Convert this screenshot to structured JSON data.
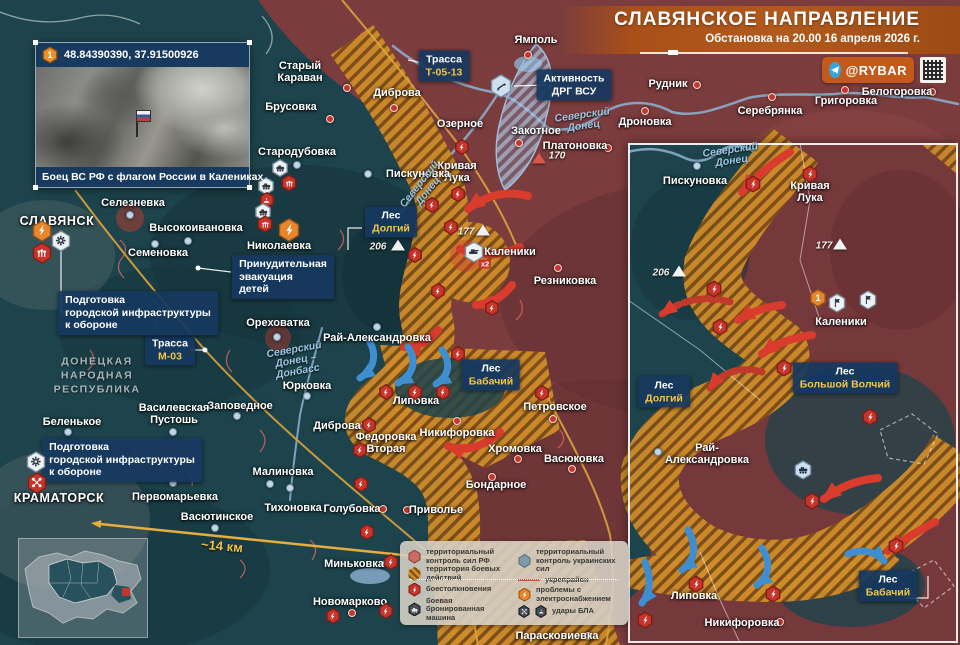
{
  "header": {
    "title": "СЛАВЯНСКОЕ НАПРАВЛЕНИЕ",
    "subtitle": "Обстановка на 20.00 16 апреля 2026 г.",
    "channel": "@RYBAR"
  },
  "photo_inset": {
    "marker": "1",
    "coordinates": "48.84390390, 37.91500926",
    "caption": "Боец ВС РФ с флагом России в Калениках"
  },
  "region_label": "ДОНЕЦКАЯ\nНАРОДНАЯ\nРЕСПУБЛИКА",
  "scale_label": "~14 км",
  "colors": {
    "rf_zone": "#7b3c3e",
    "ua_zone": "#1d444c",
    "combat_hatch": "#cf8c2a",
    "label_box": "#16385F",
    "accent_yellow": "#f2c545",
    "red_icon": "#c7342a",
    "orange_icon": "#e8862b",
    "red_arrow": "#d93b2c",
    "blue_arrow": "#3f8ed0"
  },
  "main_map": {
    "towns": [
      {
        "name": "Ямполь",
        "x": 536,
        "y": 40,
        "dot": [
          528,
          55
        ],
        "dc": "red"
      },
      {
        "name": "Старый\nКараван",
        "x": 300,
        "y": 72,
        "dot": [
          347,
          88
        ],
        "dc": "red"
      },
      {
        "name": "Диброва",
        "x": 397,
        "y": 93,
        "dot": [
          394,
          108
        ],
        "dc": "red"
      },
      {
        "name": "Брусовка",
        "x": 291,
        "y": 107,
        "dot": [
          330,
          119
        ],
        "dc": "red"
      },
      {
        "name": "Озерное",
        "x": 460,
        "y": 124
      },
      {
        "name": "Закотное",
        "x": 536,
        "y": 131,
        "dot": [
          519,
          143
        ],
        "dc": "red"
      },
      {
        "name": "Платоновка",
        "x": 575,
        "y": 146,
        "dot": [
          608,
          148
        ],
        "dc": "red"
      },
      {
        "name": "Кривая\nЛука",
        "x": 457,
        "y": 172
      },
      {
        "name": "Пискуновка",
        "x": 418,
        "y": 174,
        "dot": [
          368,
          174
        ],
        "dc": "blue"
      },
      {
        "name": "Стародубовка",
        "x": 297,
        "y": 152,
        "dot": [
          297,
          165
        ],
        "dc": "blue"
      },
      {
        "name": "Селезневка",
        "x": 133,
        "y": 203,
        "dot": [
          130,
          215
        ],
        "dc": "blue"
      },
      {
        "name": "Высокоивановка",
        "x": 196,
        "y": 228,
        "dot": [
          188,
          241
        ],
        "dc": "blue"
      },
      {
        "name": "СЛАВЯНСК",
        "x": 57,
        "y": 222,
        "cls": "city"
      },
      {
        "name": "Семеновка",
        "x": 158,
        "y": 253,
        "dot": [
          155,
          244
        ],
        "dc": "blue"
      },
      {
        "name": "Николаевка",
        "x": 279,
        "y": 246
      },
      {
        "name": "Ореховатка",
        "x": 278,
        "y": 323,
        "dot": [
          277,
          337
        ],
        "dc": "blue"
      },
      {
        "name": "Рай-Александровка",
        "x": 377,
        "y": 338,
        "dot": [
          377,
          327
        ],
        "dc": "blue"
      },
      {
        "name": "Юрковка",
        "x": 307,
        "y": 386,
        "dot": [
          307,
          396
        ],
        "dc": "blue"
      },
      {
        "name": "Заповедное",
        "x": 240,
        "y": 406,
        "dot": [
          237,
          416
        ],
        "dc": "blue"
      },
      {
        "name": "Василевская\nПустошь",
        "x": 174,
        "y": 414,
        "dot": [
          173,
          432
        ],
        "dc": "blue"
      },
      {
        "name": "Беленькое",
        "x": 72,
        "y": 422,
        "dot": [
          68,
          432
        ],
        "dc": "blue"
      },
      {
        "name": "Резниковка",
        "x": 565,
        "y": 281,
        "dot": [
          558,
          268
        ],
        "dc": "red"
      },
      {
        "name": "Каленики",
        "x": 510,
        "y": 252
      },
      {
        "name": "Липовка",
        "x": 416,
        "y": 401
      },
      {
        "name": "Петровское",
        "x": 555,
        "y": 407,
        "dot": [
          553,
          419
        ],
        "dc": "red"
      },
      {
        "name": "Никифоровка",
        "x": 457,
        "y": 433,
        "dot": [
          457,
          421
        ],
        "dc": "red"
      },
      {
        "name": "Хромовка",
        "x": 515,
        "y": 449,
        "dot": [
          518,
          459
        ],
        "dc": "red"
      },
      {
        "name": "Васюковка",
        "x": 574,
        "y": 459,
        "dot": [
          572,
          469
        ],
        "dc": "red"
      },
      {
        "name": "Бондарное",
        "x": 496,
        "y": 485,
        "dot": [
          492,
          477
        ],
        "dc": "red"
      },
      {
        "name": "Федоровка\nВторая",
        "x": 386,
        "y": 443
      },
      {
        "name": "Диброва",
        "x": 337,
        "y": 426,
        "dot": [
          364,
          426
        ],
        "dc": "red"
      },
      {
        "name": "Малиновка",
        "x": 283,
        "y": 472,
        "dot": [
          270,
          484
        ],
        "dc": "blue"
      },
      {
        "name": "Первомарьевка",
        "x": 175,
        "y": 497,
        "dot": [
          173,
          483
        ],
        "dc": "blue"
      },
      {
        "name": "Васютинское",
        "x": 217,
        "y": 517,
        "dot": [
          215,
          528
        ],
        "dc": "blue"
      },
      {
        "name": "Тихоновка",
        "x": 293,
        "y": 508,
        "dot": [
          290,
          488
        ],
        "dc": "blue"
      },
      {
        "name": "Голубовка",
        "x": 352,
        "y": 509,
        "dot": [
          383,
          509
        ],
        "dc": "red"
      },
      {
        "name": "Приволье",
        "x": 436,
        "y": 510,
        "dot": [
          407,
          510
        ],
        "dc": "red"
      },
      {
        "name": "Миньковка",
        "x": 354,
        "y": 564,
        "dot": [
          387,
          563
        ],
        "dc": "red"
      },
      {
        "name": "Новомарково",
        "x": 350,
        "y": 602,
        "dot": [
          352,
          613
        ],
        "dc": "red"
      },
      {
        "name": "Парасковиевка",
        "x": 557,
        "y": 636,
        "dot": [
          588,
          636
        ],
        "dc": "red"
      },
      {
        "name": "КРАМАТОРСК",
        "x": 59,
        "y": 499,
        "cls": "city"
      },
      {
        "name": "Рудник",
        "x": 668,
        "y": 84,
        "dot": [
          697,
          85
        ],
        "dc": "red"
      },
      {
        "name": "Дроновка",
        "x": 645,
        "y": 122,
        "dot": [
          645,
          111
        ],
        "dc": "red"
      },
      {
        "name": "Серебрянка",
        "x": 770,
        "y": 111,
        "dot": [
          772,
          97
        ],
        "dc": "red"
      },
      {
        "name": "Григоровка",
        "x": 846,
        "y": 101,
        "dot": [
          845,
          90
        ],
        "dc": "red"
      },
      {
        "name": "Белогоровка",
        "x": 897,
        "y": 92,
        "dot": [
          932,
          92
        ],
        "dc": "red"
      }
    ],
    "boxed_labels": [
      {
        "lines": [
          [
            "Трасса",
            "w"
          ],
          [
            "Т-05-13",
            "y"
          ]
        ],
        "x": 444,
        "y": 66
      },
      {
        "lines": [
          [
            "Активность",
            "w"
          ],
          [
            "ДРГ ВСУ",
            "w"
          ]
        ],
        "x": 574,
        "y": 85
      },
      {
        "lines": [
          [
            "Лес",
            "w"
          ],
          [
            "Долгий",
            "y"
          ]
        ],
        "x": 391,
        "y": 222
      },
      {
        "lines": [
          [
            "Лес",
            "w"
          ],
          [
            "Бабачий",
            "y"
          ]
        ],
        "x": 491,
        "y": 375
      },
      {
        "lines": [
          [
            "Трасса",
            "w"
          ],
          [
            "М-03",
            "y"
          ]
        ],
        "x": 170,
        "y": 350
      },
      {
        "lines": [
          [
            "Подготовка",
            "w"
          ],
          [
            "городской инфраструктуры",
            "w"
          ],
          [
            "к обороне",
            "w"
          ]
        ],
        "x": 138,
        "y": 313,
        "cls": "para"
      },
      {
        "lines": [
          [
            "Подготовка",
            "w"
          ],
          [
            "городской инфраструктуры",
            "w"
          ],
          [
            "к обороне",
            "w"
          ]
        ],
        "x": 122,
        "y": 460,
        "cls": "para"
      },
      {
        "lines": [
          [
            "Принудительная",
            "w"
          ],
          [
            "эвакуация",
            "w"
          ],
          [
            "детей",
            "w"
          ]
        ],
        "x": 283,
        "y": 277,
        "cls": "para"
      }
    ],
    "water_labels": [
      {
        "text": "Северский\nДонец",
        "x": 583,
        "y": 121,
        "r": -8
      },
      {
        "text": "Северский\nДонец",
        "x": 424,
        "y": 188,
        "r": -52
      },
      {
        "text": "Северский\nДонец –\nДонбасс",
        "x": 296,
        "y": 361,
        "r": -10
      }
    ],
    "elevations": [
      {
        "v": "170",
        "x": 557,
        "y": 156,
        "tx": 539,
        "ty": 158,
        "tc": "red"
      },
      {
        "v": "206",
        "x": 378,
        "y": 247,
        "tx": 398,
        "ty": 245
      },
      {
        "v": "177",
        "x": 466,
        "y": 232,
        "tx": 483,
        "ty": 230
      }
    ],
    "icons": [
      {
        "t": "lightning",
        "c": "org",
        "x": 42,
        "y": 231,
        "s": 20
      },
      {
        "t": "gear",
        "c": "wht",
        "x": 61,
        "y": 241,
        "s": 20
      },
      {
        "t": "arrows",
        "c": "red",
        "x": 42,
        "y": 253,
        "s": 20
      },
      {
        "t": "gear",
        "c": "wht",
        "x": 36,
        "y": 462,
        "s": 20
      },
      {
        "t": "drone",
        "c": "red",
        "x": 37,
        "y": 483,
        "s": 20
      },
      {
        "t": "vehicle",
        "c": "wht",
        "x": 280,
        "y": 168,
        "s": 17
      },
      {
        "t": "arrows",
        "c": "red",
        "x": 289,
        "y": 183,
        "s": 16
      },
      {
        "t": "vehicle",
        "c": "wht",
        "x": 266,
        "y": 186,
        "s": 17
      },
      {
        "t": "dome",
        "c": "red",
        "x": 267,
        "y": 200,
        "s": 15
      },
      {
        "t": "vehicle",
        "c": "wht",
        "x": 263,
        "y": 212,
        "s": 17
      },
      {
        "t": "arrows",
        "c": "red",
        "x": 265,
        "y": 224,
        "s": 16
      },
      {
        "t": "lightning",
        "c": "org",
        "x": 289,
        "y": 230,
        "s": 22
      },
      {
        "t": "rifle",
        "c": "lbl",
        "x": 501,
        "y": 86,
        "s": 22
      },
      {
        "t": "lightning",
        "c": "red",
        "x": 462,
        "y": 147,
        "s": 15
      },
      {
        "t": "lightning",
        "c": "red",
        "x": 458,
        "y": 194,
        "s": 15
      },
      {
        "t": "lightning",
        "c": "red",
        "x": 432,
        "y": 205,
        "s": 15
      },
      {
        "t": "lightning",
        "c": "red",
        "x": 451,
        "y": 227,
        "s": 15
      },
      {
        "t": "lightning",
        "c": "red",
        "x": 415,
        "y": 255,
        "s": 15
      },
      {
        "t": "lightning",
        "c": "red",
        "x": 438,
        "y": 291,
        "s": 15
      },
      {
        "t": "lightning",
        "c": "red",
        "x": 492,
        "y": 308,
        "s": 15
      },
      {
        "t": "tank",
        "c": "wht",
        "x": 474,
        "y": 252,
        "s": 20,
        "badge": "x2"
      },
      {
        "t": "lightning",
        "c": "red",
        "x": 458,
        "y": 354,
        "s": 15
      },
      {
        "t": "lightning",
        "c": "red",
        "x": 386,
        "y": 392,
        "s": 15
      },
      {
        "t": "lightning",
        "c": "red",
        "x": 415,
        "y": 392,
        "s": 15
      },
      {
        "t": "lightning",
        "c": "red",
        "x": 443,
        "y": 392,
        "s": 15
      },
      {
        "t": "lightning",
        "c": "red",
        "x": 369,
        "y": 425,
        "s": 15
      },
      {
        "t": "lightning",
        "c": "red",
        "x": 360,
        "y": 450,
        "s": 15
      },
      {
        "t": "lightning",
        "c": "red",
        "x": 542,
        "y": 393,
        "s": 15
      },
      {
        "t": "lightning",
        "c": "red",
        "x": 361,
        "y": 484,
        "s": 15
      },
      {
        "t": "lightning",
        "c": "red",
        "x": 367,
        "y": 532,
        "s": 15
      },
      {
        "t": "lightning",
        "c": "red",
        "x": 391,
        "y": 562,
        "s": 15
      },
      {
        "t": "lightning",
        "c": "red",
        "x": 333,
        "y": 616,
        "s": 15
      },
      {
        "t": "lightning",
        "c": "red",
        "x": 386,
        "y": 611,
        "s": 15
      }
    ]
  },
  "right_inset": {
    "towns": [
      {
        "name": "Пискуновка",
        "x": 695,
        "y": 181,
        "dot": [
          697,
          166
        ],
        "dc": "blue"
      },
      {
        "name": "Кривая\nЛука",
        "x": 810,
        "y": 192
      },
      {
        "name": "Каленики",
        "x": 841,
        "y": 322
      },
      {
        "name": "Рай-\nАлександровка",
        "x": 707,
        "y": 454,
        "dot": [
          658,
          452
        ],
        "dc": "blue"
      },
      {
        "name": "Липовка",
        "x": 694,
        "y": 596
      },
      {
        "name": "Никифоровка",
        "x": 742,
        "y": 623,
        "dot": [
          780,
          622
        ],
        "dc": "red"
      }
    ],
    "boxed_labels": [
      {
        "lines": [
          [
            "Лес",
            "w"
          ],
          [
            "Большой Волчий",
            "y"
          ]
        ],
        "x": 845,
        "y": 378
      },
      {
        "lines": [
          [
            "Лес",
            "w"
          ],
          [
            "Долгий",
            "y"
          ]
        ],
        "x": 664,
        "y": 392
      },
      {
        "lines": [
          [
            "Лес",
            "w"
          ],
          [
            "Бабачий",
            "y"
          ]
        ],
        "x": 888,
        "y": 586
      }
    ],
    "water_labels": [
      {
        "text": "Северский\nДонец",
        "x": 731,
        "y": 156,
        "r": -8
      }
    ],
    "elevations": [
      {
        "v": "177",
        "x": 824,
        "y": 246,
        "tx": 840,
        "ty": 244
      },
      {
        "v": "206",
        "x": 661,
        "y": 273,
        "tx": 679,
        "ty": 271
      }
    ],
    "icons": [
      {
        "t": "num",
        "n": "1",
        "c": "org",
        "x": 818,
        "y": 298,
        "s": 17
      },
      {
        "t": "flag",
        "c": "wht",
        "x": 837,
        "y": 303,
        "s": 18
      },
      {
        "t": "flag",
        "c": "wht",
        "x": 868,
        "y": 300,
        "s": 18
      },
      {
        "t": "vehicle",
        "c": "lbl",
        "x": 803,
        "y": 470,
        "s": 18
      },
      {
        "t": "lightning",
        "c": "red",
        "x": 753,
        "y": 184,
        "s": 16
      },
      {
        "t": "lightning",
        "c": "red",
        "x": 810,
        "y": 174,
        "s": 16
      },
      {
        "t": "lightning",
        "c": "red",
        "x": 714,
        "y": 289,
        "s": 16
      },
      {
        "t": "lightning",
        "c": "red",
        "x": 720,
        "y": 327,
        "s": 16
      },
      {
        "t": "lightning",
        "c": "red",
        "x": 784,
        "y": 368,
        "s": 16
      },
      {
        "t": "lightning",
        "c": "red",
        "x": 870,
        "y": 417,
        "s": 16
      },
      {
        "t": "lightning",
        "c": "red",
        "x": 812,
        "y": 501,
        "s": 16
      },
      {
        "t": "lightning",
        "c": "red",
        "x": 896,
        "y": 546,
        "s": 16
      },
      {
        "t": "lightning",
        "c": "red",
        "x": 696,
        "y": 584,
        "s": 16
      },
      {
        "t": "lightning",
        "c": "red",
        "x": 645,
        "y": 620,
        "s": 16
      },
      {
        "t": "lightning",
        "c": "red",
        "x": 773,
        "y": 594,
        "s": 16
      }
    ]
  },
  "legend": {
    "items": [
      {
        "icon": "rf",
        "label": "территориальный контроль сил РФ",
        "col": 1
      },
      {
        "icon": "combat",
        "label": "территория боевых действий",
        "col": 1
      },
      {
        "icon": "clash",
        "label": "боестолкновения",
        "col": 1
      },
      {
        "icon": "afv",
        "label": "боевая бронированная машина",
        "col": 1
      },
      {
        "icon": "ua",
        "label": "территориальный контроль украинских сил",
        "col": 2
      },
      {
        "icon": "fort",
        "label": "укрепрайон",
        "col": 2
      },
      {
        "icon": "power",
        "label": "проблемы с электроснабжением",
        "col": 2
      },
      {
        "icon": "uav",
        "label": "удары БЛА",
        "col": 2
      }
    ]
  }
}
